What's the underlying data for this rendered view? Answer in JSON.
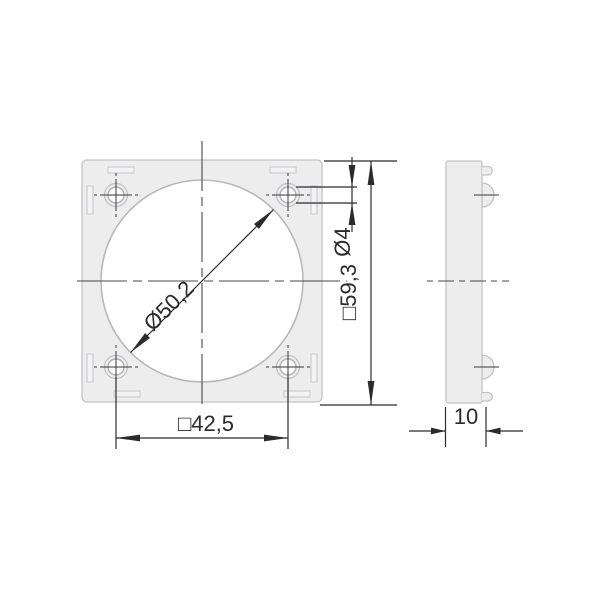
{
  "dimensions": {
    "bore_diameter": "Ø50,2",
    "corner_hole_diameter": "Ø4",
    "outer_square": "□59,3",
    "hole_spacing": "□42,5",
    "thickness": "10"
  },
  "colors": {
    "dimension_lines": "#2b2b2d",
    "part_outline": "#c4c4c8",
    "part_fill": "#ededee",
    "bore_outline": "#b9b9bd",
    "centerlines": "#48484a",
    "background": "#ffffff"
  }
}
